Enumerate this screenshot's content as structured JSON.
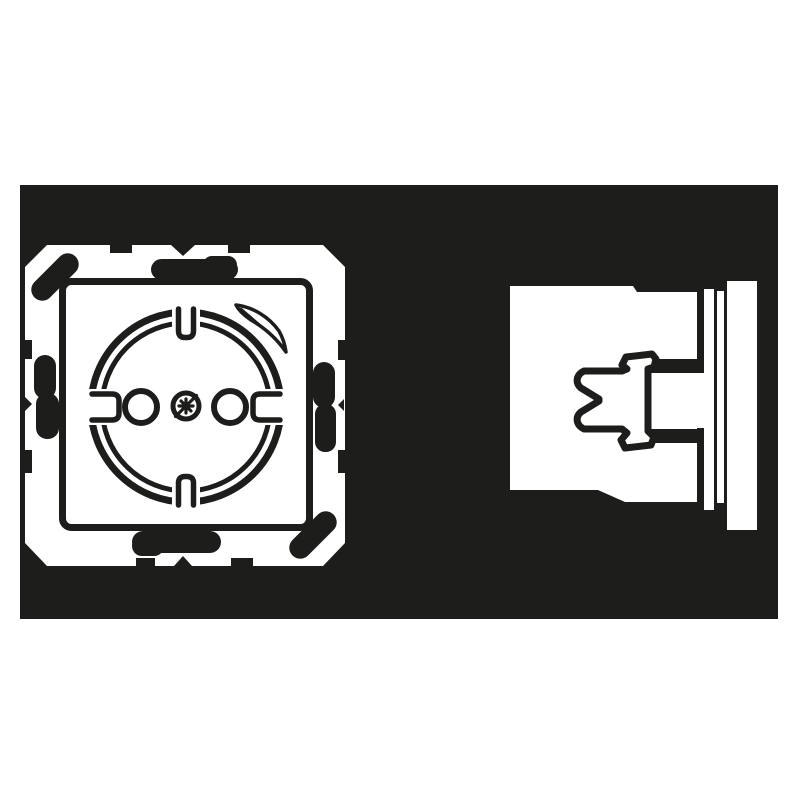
{
  "meta": {
    "description": "Monochrome technical line drawing of a flush-mounted Schuko socket outlet shown on a dark rectangular panel: front view at left, side profile view at right. No text is rendered in the image."
  },
  "colors": {
    "ink": "#1d1d1b",
    "paper": "#ffffff"
  },
  "panel": {
    "label": "dark-illustration-panel"
  },
  "views": {
    "front": {
      "label": "schuko-socket-front-view",
      "parts": [
        "mounting-frame",
        "fixing-claw-marks",
        "cover-plate",
        "socket-well",
        "earth-contact-top",
        "earth-contact-bottom",
        "side-guide-notch-left",
        "side-guide-notch-right",
        "pin-hole-left",
        "pin-hole-right",
        "combi-screw",
        "rotation-arrow-mark"
      ]
    },
    "side": {
      "label": "schuko-socket-side-view",
      "parts": [
        "insert-body",
        "earth-clip-profile",
        "claw-slot-upper",
        "claw-slot-lower",
        "support-ring-edge",
        "frame-edge",
        "cover-plate-edge"
      ]
    }
  }
}
